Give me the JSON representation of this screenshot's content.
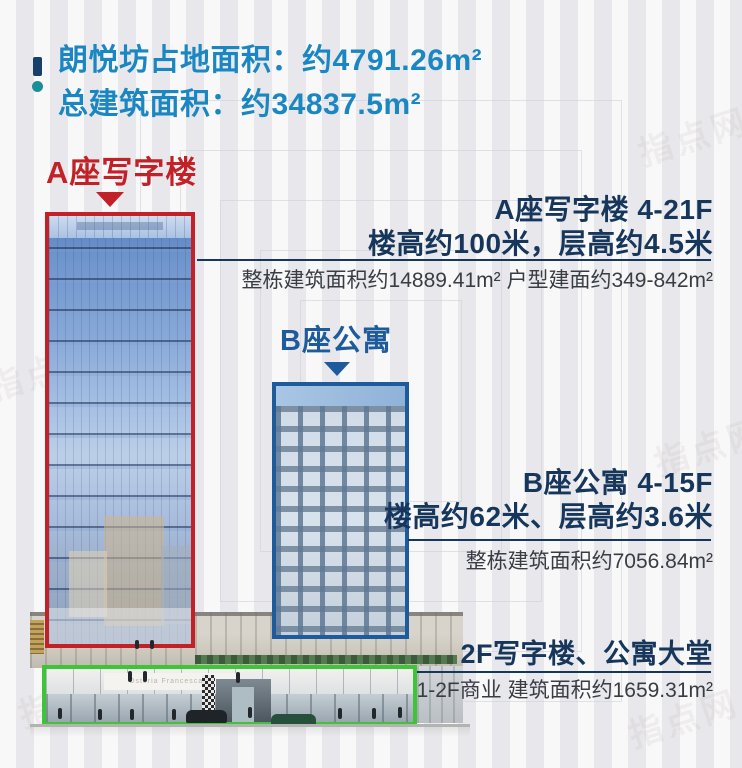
{
  "header": {
    "site_area": "朗悦坊占地面积：约4791.26m²",
    "total_floor_area": "总建筑面积：约34837.5m²",
    "accent_color": "#1a86c2"
  },
  "tower_a": {
    "label": "A座写字楼",
    "accent_color": "#c22127",
    "info_title": "A座写字楼 4-21F",
    "info_subtitle": "楼高约100米，层高约4.5米",
    "info_detail": "整栋建筑面积约14889.41m² 户型建面约349-842m²"
  },
  "tower_b": {
    "label": "B座公寓",
    "accent_color": "#1d5b9c",
    "info_title": "B座公寓 4-15F",
    "info_subtitle": "楼高约62米、层高约3.6米",
    "info_detail": "整栋建筑面积约7056.84m²"
  },
  "podium": {
    "accent_color": "#3ec437",
    "info_title": "2F写字楼、公寓大堂",
    "info_detail": "1-2F商业 建筑面积约1659.31m²",
    "sign_text": "Osteria Francescana"
  },
  "watermark": {
    "text": "指点网"
  },
  "colors": {
    "headline_navy": "#16365c",
    "detail_gray": "#383d44",
    "background": "#f0f0f2"
  }
}
